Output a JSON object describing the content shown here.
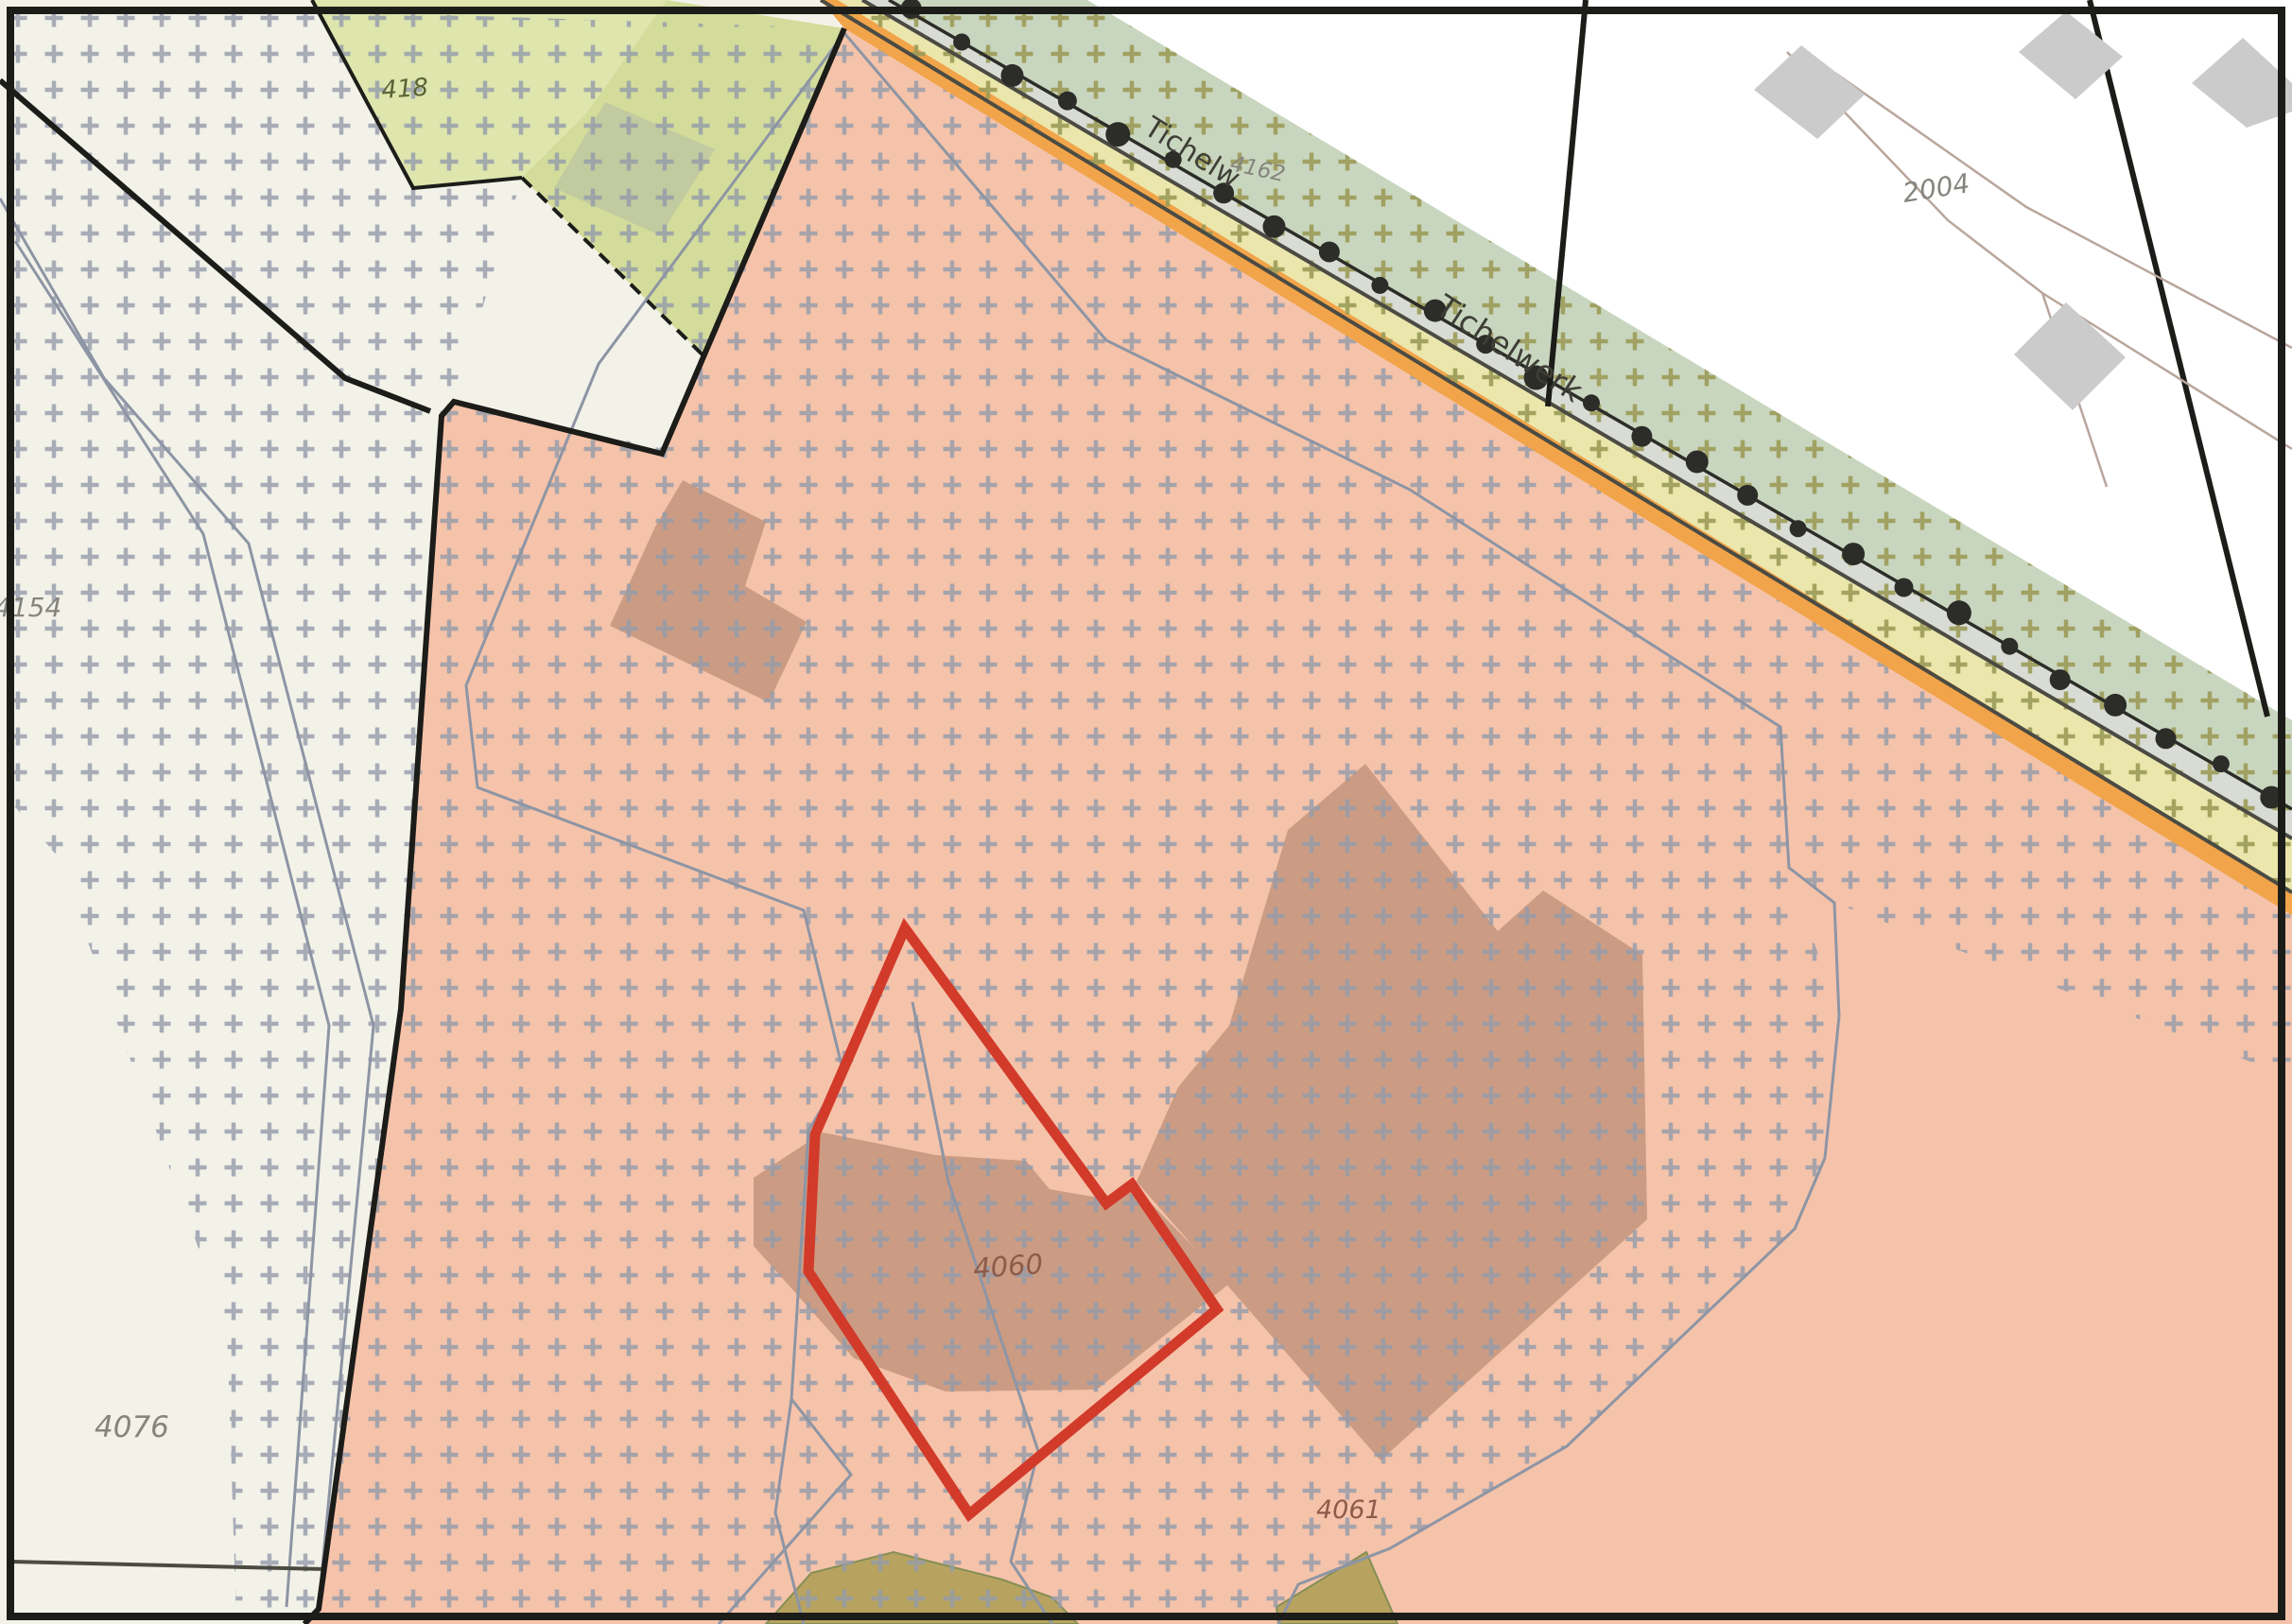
{
  "map_labels": {
    "street": [
      {
        "text": "Tichelw"
      },
      {
        "text": "Tichelwerk"
      }
    ],
    "parcels": [
      {
        "id": "418"
      },
      {
        "id": "4162"
      },
      {
        "id": "2004"
      },
      {
        "id": "4154"
      },
      {
        "id": "4076"
      },
      {
        "id": "4060"
      },
      {
        "id": "4061"
      }
    ]
  },
  "highlight": {
    "selected_parcel": "4060",
    "outline_color": "#d23a2a"
  },
  "colors": {
    "pink": "#f5c3aa",
    "brown": "#cb9c83",
    "offwhite": "#f3f2e9",
    "green_pale": "#dee5ad",
    "green_dark": "#d3dc9a",
    "green_building": "#c2caa0",
    "sage": "#c9d6bf",
    "yellow": "#ebe6ac",
    "band_gray": "#d8dcd4",
    "orange": "#f1a449",
    "cross_gray": "#939baa",
    "cross_olive": "#9b9b57",
    "line_gray": "#8d95a4",
    "line_brown": "#b9a69d",
    "boundary_black": "#1c1c19",
    "road_line": "#4b4b43",
    "tree": "#2c2c28",
    "red": "#d23a2a",
    "building_gray": "#cbcbcb",
    "olive": "#b2a159",
    "olive_edge": "#7d8a4f",
    "label_gray": "#85857e",
    "label_brown": "#8d5b49",
    "label_green": "#5a6237",
    "street_label": "#3e3e37"
  }
}
